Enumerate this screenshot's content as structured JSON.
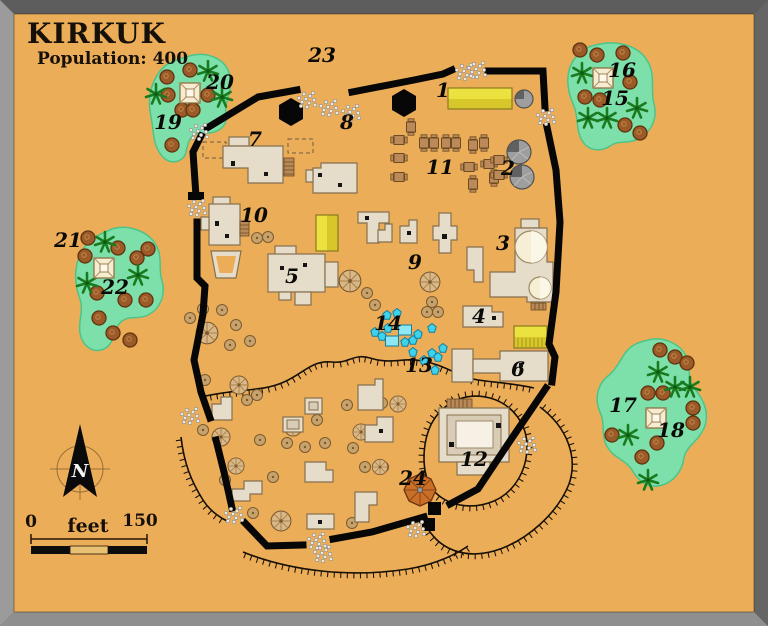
{
  "header": {
    "title": "KIRKUK",
    "subtitle": "Population: 400"
  },
  "scale_bar": {
    "start": "0",
    "unit": "feet",
    "end": "150"
  },
  "compass": {
    "north_label": "N"
  },
  "colors": {
    "parchment": "#ecad58",
    "oasis_green": "#7de0ab",
    "wall_black": "#070707",
    "building_beige": "#e6dcca",
    "yellow_building": "#ece23f",
    "water_cyan": "#3ed2ec",
    "frame_gray": "#8f8f8f"
  },
  "markers": [
    {
      "n": "1",
      "x": 443,
      "y": 90
    },
    {
      "n": "2",
      "x": 508,
      "y": 168
    },
    {
      "n": "3",
      "x": 503,
      "y": 243
    },
    {
      "n": "4",
      "x": 479,
      "y": 316
    },
    {
      "n": "5",
      "x": 292,
      "y": 276
    },
    {
      "n": "6",
      "x": 518,
      "y": 369
    },
    {
      "n": "7",
      "x": 255,
      "y": 139
    },
    {
      "n": "8",
      "x": 347,
      "y": 122
    },
    {
      "n": "9",
      "x": 415,
      "y": 262
    },
    {
      "n": "10",
      "x": 254,
      "y": 215
    },
    {
      "n": "11",
      "x": 440,
      "y": 167
    },
    {
      "n": "12",
      "x": 474,
      "y": 459
    },
    {
      "n": "13",
      "x": 419,
      "y": 365
    },
    {
      "n": "14",
      "x": 388,
      "y": 323
    },
    {
      "n": "15",
      "x": 615,
      "y": 98
    },
    {
      "n": "16",
      "x": 622,
      "y": 70
    },
    {
      "n": "17",
      "x": 623,
      "y": 405
    },
    {
      "n": "18",
      "x": 671,
      "y": 430
    },
    {
      "n": "19",
      "x": 168,
      "y": 122
    },
    {
      "n": "20",
      "x": 220,
      "y": 82
    },
    {
      "n": "21",
      "x": 68,
      "y": 240
    },
    {
      "n": "22",
      "x": 115,
      "y": 287
    },
    {
      "n": "23",
      "x": 322,
      "y": 55
    },
    {
      "n": "24",
      "x": 413,
      "y": 478
    }
  ],
  "features": {
    "shade_trees": [
      [
        167,
        77
      ],
      [
        190,
        70
      ],
      [
        208,
        95
      ],
      [
        168,
        95
      ],
      [
        182,
        110
      ],
      [
        193,
        110
      ],
      [
        172,
        145
      ],
      [
        580,
        50
      ],
      [
        597,
        55
      ],
      [
        623,
        53
      ],
      [
        630,
        82
      ],
      [
        585,
        97
      ],
      [
        600,
        100
      ],
      [
        625,
        125
      ],
      [
        640,
        133
      ],
      [
        88,
        238
      ],
      [
        118,
        248
      ],
      [
        148,
        249
      ],
      [
        85,
        256
      ],
      [
        137,
        258
      ],
      [
        97,
        293
      ],
      [
        125,
        300
      ],
      [
        146,
        300
      ],
      [
        99,
        318
      ],
      [
        113,
        333
      ],
      [
        130,
        340
      ],
      [
        660,
        350
      ],
      [
        675,
        357
      ],
      [
        687,
        363
      ],
      [
        648,
        393
      ],
      [
        663,
        393
      ],
      [
        693,
        408
      ],
      [
        693,
        423
      ],
      [
        612,
        435
      ],
      [
        657,
        443
      ],
      [
        642,
        457
      ]
    ],
    "palm_trees": [
      [
        156,
        94
      ],
      [
        208,
        71
      ],
      [
        222,
        97
      ],
      [
        582,
        73
      ],
      [
        588,
        118
      ],
      [
        607,
        118
      ],
      [
        637,
        108
      ],
      [
        105,
        242
      ],
      [
        138,
        275
      ],
      [
        87,
        283
      ],
      [
        658,
        372
      ],
      [
        675,
        387
      ],
      [
        690,
        387
      ],
      [
        628,
        435
      ],
      [
        648,
        480
      ]
    ],
    "camps": [
      [
        190,
        93
      ],
      [
        603,
        78
      ],
      [
        104,
        268
      ],
      [
        656,
        418
      ]
    ],
    "round_tents": [
      [
        207,
        333,
        1.2
      ],
      [
        239,
        385,
        1
      ],
      [
        221,
        437,
        1
      ],
      [
        236,
        466,
        0.9
      ],
      [
        281,
        521,
        1.1
      ],
      [
        350,
        281,
        1.2
      ],
      [
        361,
        432,
        0.9
      ],
      [
        398,
        404,
        0.9
      ],
      [
        430,
        282,
        1.1
      ],
      [
        380,
        467,
        0.85
      ],
      [
        293,
        427,
        1
      ]
    ],
    "huts": [
      [
        190,
        318
      ],
      [
        203,
        309
      ],
      [
        222,
        310
      ],
      [
        236,
        325
      ],
      [
        250,
        341
      ],
      [
        230,
        345
      ],
      [
        205,
        380
      ],
      [
        203,
        430
      ],
      [
        225,
        480
      ],
      [
        253,
        513
      ],
      [
        247,
        400
      ],
      [
        257,
        395
      ],
      [
        260,
        440
      ],
      [
        273,
        477
      ],
      [
        287,
        443
      ],
      [
        305,
        447
      ],
      [
        325,
        443
      ],
      [
        317,
        420
      ],
      [
        347,
        405
      ],
      [
        382,
        403
      ],
      [
        353,
        448
      ],
      [
        380,
        430
      ],
      [
        365,
        467
      ],
      [
        383,
        467
      ],
      [
        352,
        523
      ],
      [
        367,
        293
      ],
      [
        375,
        305
      ],
      [
        432,
        302
      ],
      [
        427,
        312
      ],
      [
        438,
        312
      ],
      [
        257,
        238
      ],
      [
        268,
        237
      ]
    ],
    "market_stalls": [
      [
        399,
        140,
        0
      ],
      [
        399,
        158,
        0
      ],
      [
        399,
        177,
        0
      ],
      [
        411,
        127,
        90
      ],
      [
        424,
        143,
        90
      ],
      [
        434,
        143,
        90
      ],
      [
        446,
        143,
        90
      ],
      [
        456,
        143,
        90
      ],
      [
        473,
        145,
        90
      ],
      [
        484,
        143,
        90
      ],
      [
        469,
        167,
        0
      ],
      [
        473,
        184,
        90
      ],
      [
        489,
        164,
        0
      ],
      [
        494,
        178,
        90
      ],
      [
        499,
        160,
        0
      ],
      [
        499,
        175,
        0
      ]
    ],
    "water_jars": [
      [
        387,
        315
      ],
      [
        397,
        313
      ],
      [
        375,
        332
      ],
      [
        382,
        336
      ],
      [
        388,
        328
      ],
      [
        405,
        342
      ],
      [
        413,
        340
      ],
      [
        418,
        334
      ],
      [
        432,
        328
      ],
      [
        443,
        348
      ],
      [
        432,
        353
      ],
      [
        438,
        357
      ],
      [
        435,
        370
      ],
      [
        413,
        352
      ],
      [
        424,
        360
      ]
    ],
    "water_pools": [
      [
        405,
        330
      ],
      [
        392,
        341
      ]
    ],
    "rubble_gates": [
      [
        198,
        131
      ],
      [
        306,
        99
      ],
      [
        328,
        107
      ],
      [
        350,
        112
      ],
      [
        464,
        71
      ],
      [
        476,
        69
      ],
      [
        545,
        116
      ],
      [
        196,
        207
      ],
      [
        189,
        415
      ],
      [
        233,
        514
      ],
      [
        316,
        540
      ],
      [
        322,
        553
      ],
      [
        526,
        444
      ],
      [
        415,
        528
      ]
    ]
  }
}
